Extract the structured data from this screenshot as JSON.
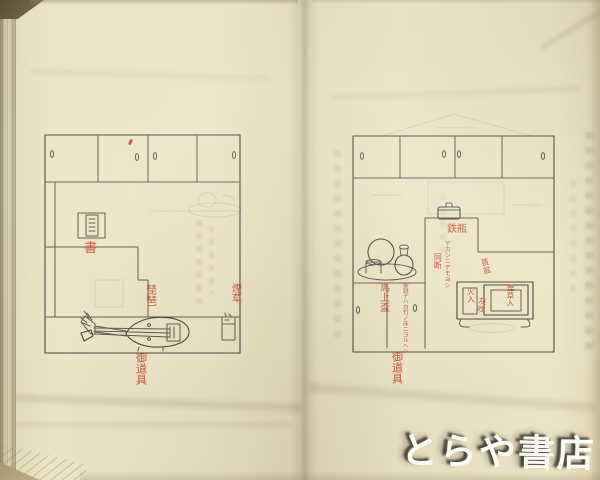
{
  "scan": {
    "watermark_text": "とらや書店",
    "colors": {
      "paper": "#e9e1c2",
      "pencil_ink": "#59544a",
      "annotation_red": "#b94a33",
      "watermark": "#fcfcf6"
    }
  },
  "left_page": {
    "labels": {
      "book": "書",
      "biwa": "琵琶",
      "tobacco": "煙草",
      "caption": "御道具"
    }
  },
  "right_page": {
    "labels": {
      "kettle": "鉄瓶",
      "kettle_note": "ヤカンニテモヨシ",
      "ditto_note": "同断",
      "sake_tray": "馬上盃",
      "sake_note": "御銚子ハ白竹ノ床ニヨルヘシ",
      "tabako_bon": "莨盆",
      "fire_cup": "火入",
      "ash_tube": "灰吹",
      "tobacco_case": "煙草入",
      "caption": "御道具"
    }
  }
}
